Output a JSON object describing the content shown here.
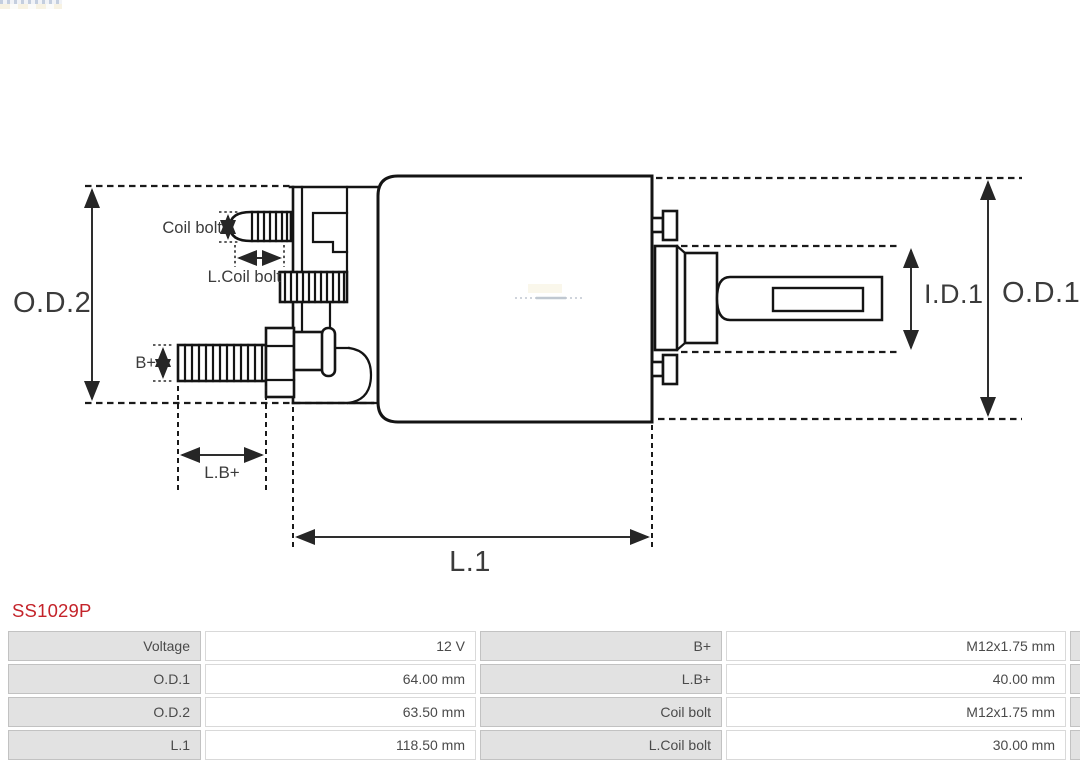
{
  "part_number": {
    "text": "SS1029P",
    "color": "#c4232a"
  },
  "drawing": {
    "labels": {
      "od2": "O.D.2",
      "coil_bolt": "Coil bolt",
      "l_coil_bolt": "L.Coil bolt",
      "b_plus": "B+",
      "l_b_plus": "L.B+",
      "l1": "L.1",
      "id1": "I.D.1",
      "od1": "O.D.1"
    },
    "line_color": "#141414",
    "dimension_text_color": "#3b3b3b"
  },
  "spec_table": {
    "rows": [
      {
        "label1": "Voltage",
        "value1": "12 V",
        "label2": "B+",
        "value2": "M12x1.75 mm"
      },
      {
        "label1": "O.D.1",
        "value1": "64.00 mm",
        "label2": "L.B+",
        "value2": "40.00 mm"
      },
      {
        "label1": "O.D.2",
        "value1": "63.50 mm",
        "label2": "Coil bolt",
        "value2": "M12x1.75 mm"
      },
      {
        "label1": "L.1",
        "value1": "118.50 mm",
        "label2": "L.Coil bolt",
        "value2": "30.00 mm"
      }
    ],
    "colors": {
      "label_bg": "#e2e2e2",
      "value_bg": "#ffffff",
      "border": "#c9c9c9",
      "text": "#4a4a4a"
    }
  }
}
